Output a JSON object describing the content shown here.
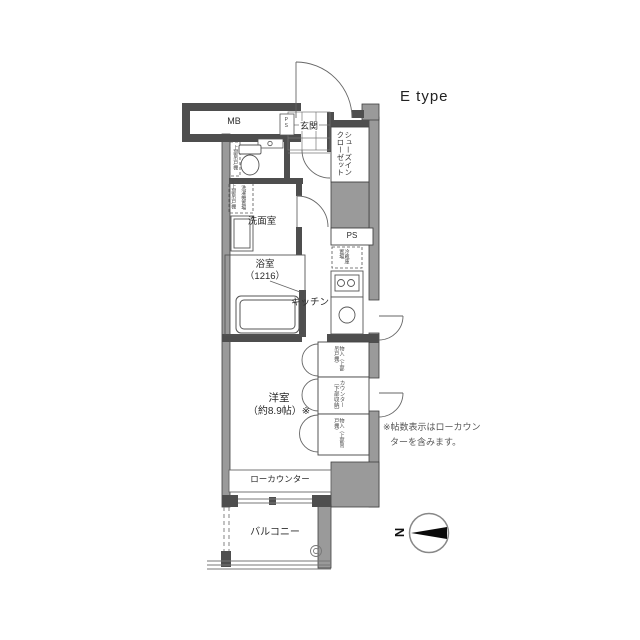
{
  "title": "E type",
  "plan": {
    "rooms": {
      "mb": "MB",
      "ps_entry": "PS",
      "genkan": "玄関",
      "sic_line1": "シューズイン",
      "sic_line2": "クローゼット",
      "toilet_shelf": "上部吊戸棚",
      "laundry_shelf": "上部吊戸棚",
      "laundry": "洗濯機置場",
      "washroom": "洗面室",
      "bathroom": "浴室",
      "bathroom_size": "（1216）",
      "kitchen": "キッチン",
      "ps": "PS",
      "fridge_line1": "冷蔵庫",
      "fridge_line2": "置場",
      "western_room": "洋室",
      "western_room_size": "（約8.9帖）※",
      "closet_top": "物入（上部吊戸棚）",
      "counter_storage": "カウンター（下部収納）",
      "closet_bottom": "物入（上部吊戸棚）",
      "low_counter": "ローカウンター",
      "balcony": "バルコニー"
    },
    "note_line1": "※帖数表示はローカウン",
    "note_line2": "ターを含みます。",
    "compass": "N"
  },
  "colors": {
    "wall_gray": "#9a9a9a",
    "wall_dark": "#4e4e4e",
    "line": "#555555",
    "needle": "#0a0a0a"
  }
}
